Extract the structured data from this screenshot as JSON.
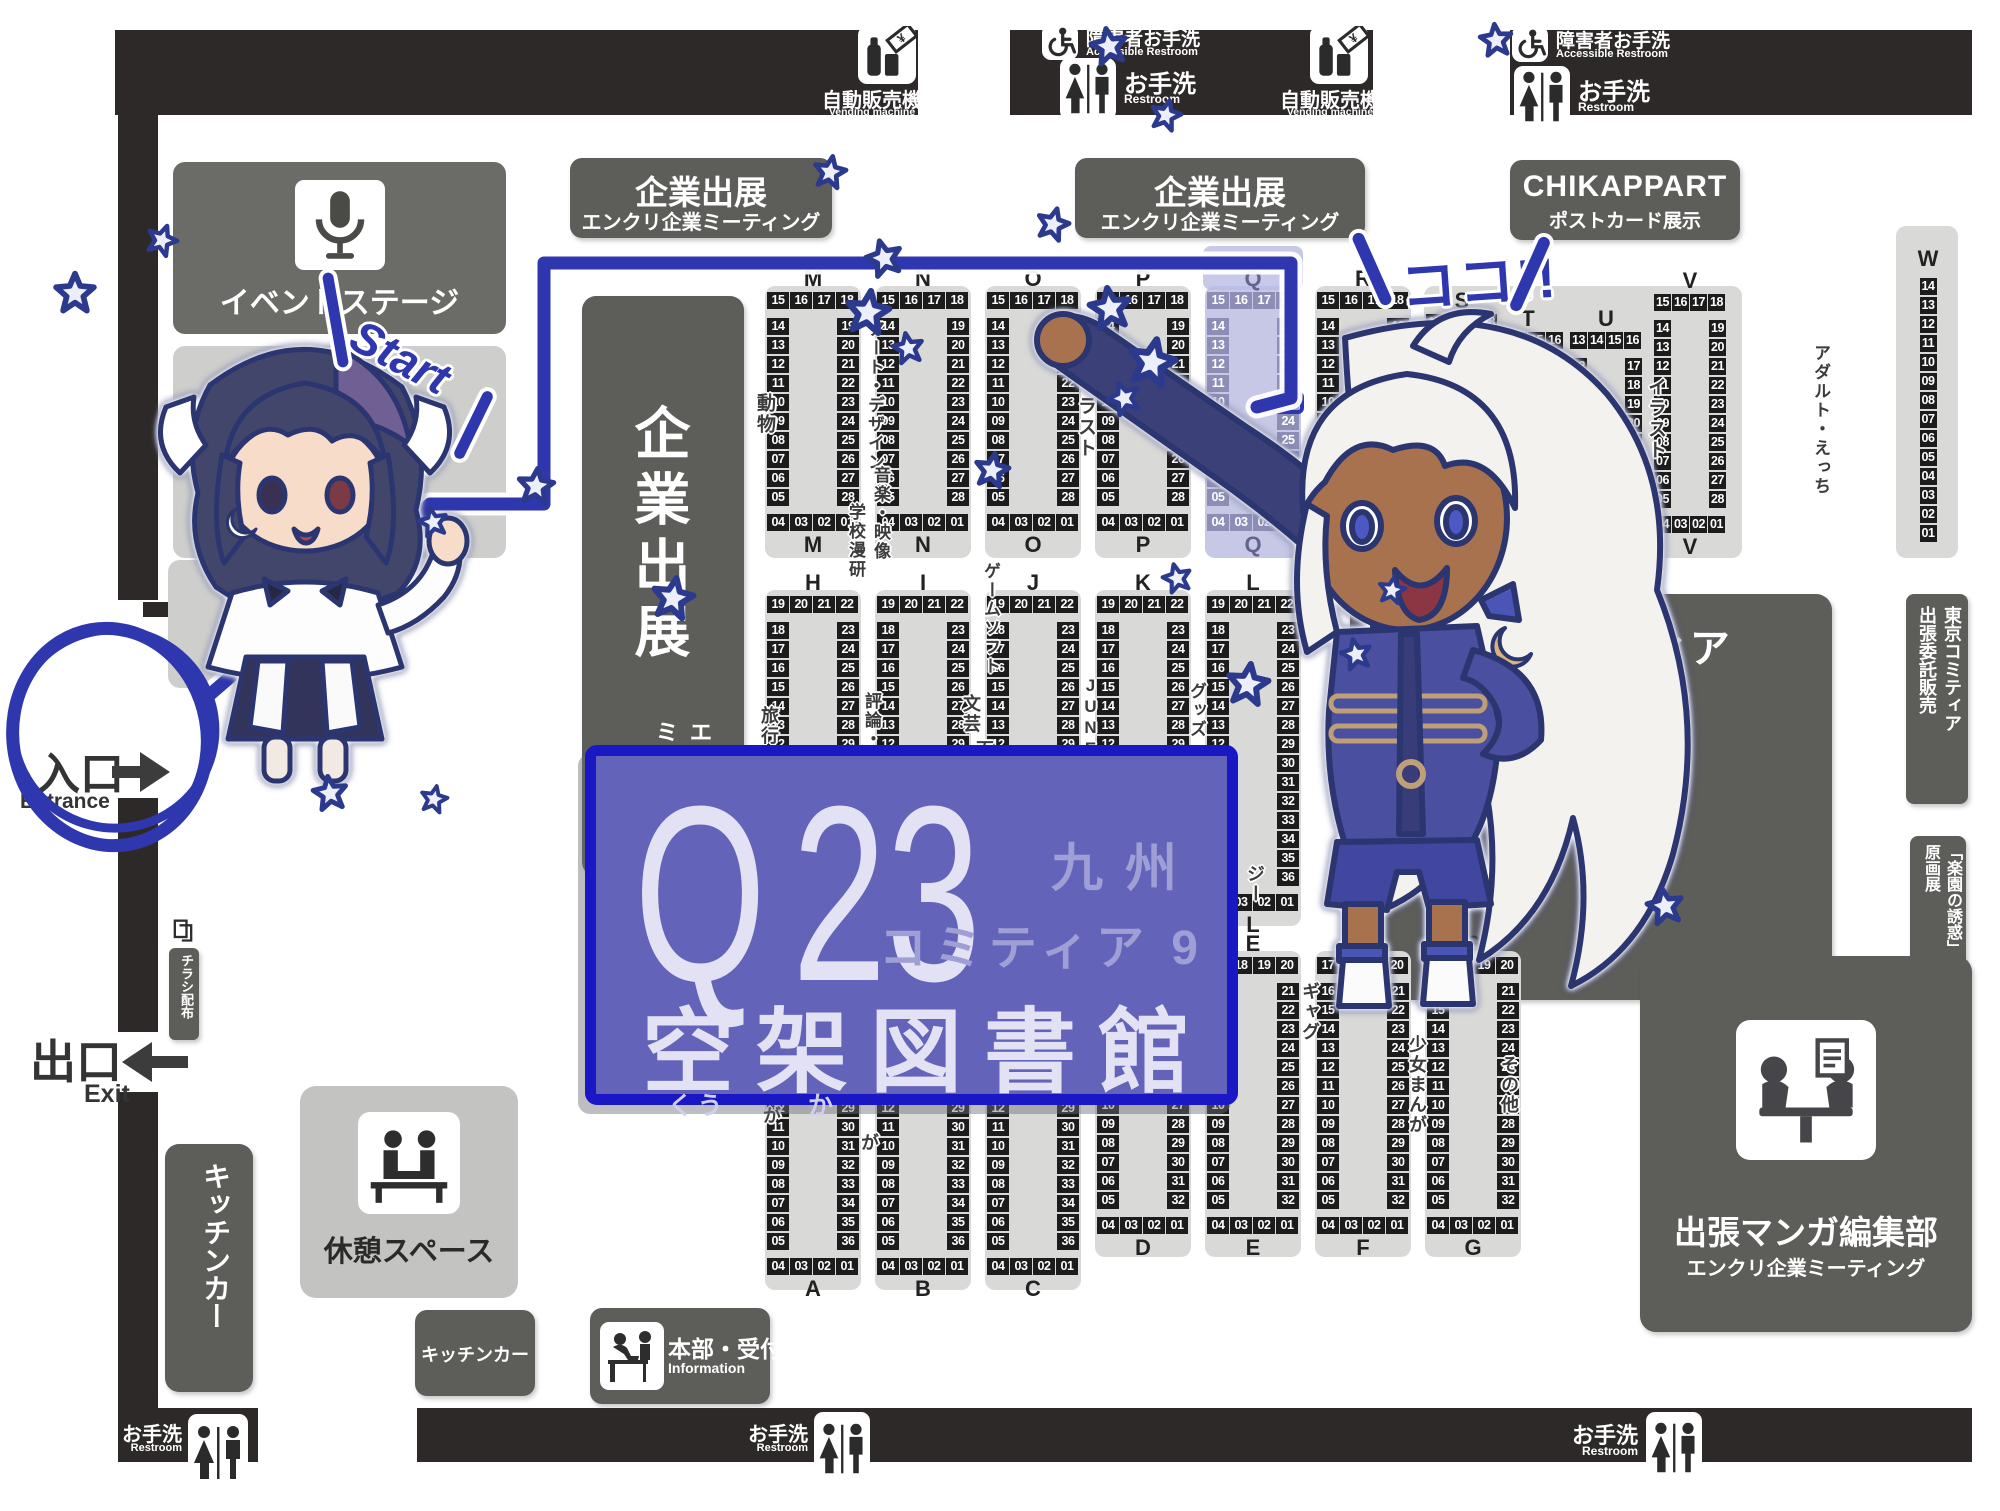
{
  "top_bar": {
    "vending_machine": {
      "jp": "自動販売機",
      "en": "Vending machine"
    },
    "accessible_restroom": {
      "jp": "障害者お手洗",
      "en": "Accessible Restroom"
    },
    "restroom": {
      "jp": "お手洗",
      "en": "Restroom"
    }
  },
  "doors": {
    "entrance_jp": "入口",
    "entrance_en": "Entrance",
    "exit_jp": "出口",
    "exit_en": "Exit"
  },
  "signs": {
    "event_stage": "イベントステージ",
    "corporate_title": "企業出展",
    "corporate_subtitle": "エンクリ企業ミーティング",
    "chikappart_title": "CHIKAPPART",
    "chikappart_subtitle": "ポストカード展示",
    "sample_book_line1": "九州コミティア",
    "sample_book_line2": "見本誌展示",
    "tokyo_line1": "東京コミティア",
    "tokyo_line2": "出張委託販売",
    "rakuen_line1": "「楽園の誘惑」",
    "rakuen_line2": "原画展",
    "editorial_title": "出張マンガ編集部",
    "editorial_subtitle": "エンクリ企業ミーティング",
    "rest_space": "休憩スペース",
    "kitchen_car": "キッチンカー",
    "flyer": "チラシ配布",
    "info_jp": "本部・受付",
    "info_en": "Information"
  },
  "banner": {
    "block": "Q",
    "number": "23",
    "event_line1": "九州",
    "event_line2": "コミティア 9",
    "name": "空架図書館",
    "furigana_sora": "くう",
    "furigana_ka": "か",
    "target": "Q23"
  },
  "annotations": {
    "start": "Start",
    "here": "ココ!!"
  },
  "booth_patterns": {
    "up10": {
      "top": [
        "15",
        "16",
        "17",
        "18"
      ],
      "left": [
        "14",
        "13",
        "12",
        "11",
        "10",
        "09",
        "08",
        "07",
        "06",
        "05"
      ],
      "right": [
        "19",
        "20",
        "21",
        "22",
        "23",
        "24",
        "25",
        "26",
        "27",
        "28"
      ],
      "bottom": [
        "04",
        "03",
        "02",
        "01"
      ]
    },
    "up8": {
      "top": [
        "13",
        "14",
        "15",
        "16"
      ],
      "left": [
        "12",
        "11",
        "10",
        "09",
        "08",
        "07",
        "06",
        "05"
      ],
      "right": [
        "17",
        "18",
        "19",
        "20",
        "21",
        "22",
        "23",
        "24"
      ],
      "bottom": [
        "04",
        "03",
        "02",
        "01"
      ]
    },
    "tall14": {
      "top": [
        "19",
        "20",
        "21",
        "22"
      ],
      "left": [
        "18",
        "17",
        "16",
        "15",
        "14",
        "13",
        "12",
        "11",
        "10",
        "09",
        "08",
        "07",
        "06",
        "05"
      ],
      "right": [
        "23",
        "24",
        "25",
        "26",
        "27",
        "28",
        "29",
        "30",
        "31",
        "32",
        "33",
        "34",
        "35",
        "36"
      ],
      "bottom": [
        "04",
        "03",
        "02",
        "01"
      ]
    },
    "mid12": {
      "top": [
        "17",
        "18",
        "19",
        "20"
      ],
      "left": [
        "16",
        "15",
        "14",
        "13",
        "12",
        "11",
        "10",
        "09",
        "08",
        "07",
        "06",
        "05"
      ],
      "right": [
        "21",
        "22",
        "23",
        "24",
        "25",
        "26",
        "27",
        "28",
        "29",
        "30",
        "31",
        "32"
      ],
      "bottom": [
        "04",
        "03",
        "02",
        "01"
      ]
    },
    "wcol": {
      "col": [
        "14",
        "13",
        "12",
        "11",
        "10",
        "09",
        "08",
        "07",
        "06",
        "05",
        "04",
        "03",
        "02",
        "01"
      ]
    }
  },
  "map": {
    "booth_blocks": [
      {
        "l": "M",
        "p": "up10",
        "cx": 813,
        "y": 268
      },
      {
        "l": "N",
        "p": "up10",
        "cx": 923,
        "y": 268
      },
      {
        "l": "O",
        "p": "up10",
        "cx": 1033,
        "y": 268
      },
      {
        "l": "P",
        "p": "up10",
        "cx": 1143,
        "y": 268
      },
      {
        "l": "Q",
        "p": "up10",
        "cx": 1253,
        "y": 268,
        "hl": true
      },
      {
        "l": "R",
        "p": "up10",
        "cx": 1363,
        "y": 268
      },
      {
        "l": "S",
        "p": "up10",
        "cx": 1462,
        "y": 290,
        "n": true
      },
      {
        "l": "T",
        "p": "up8",
        "cx": 1528,
        "y": 308,
        "n": true
      },
      {
        "l": "U",
        "p": "up8",
        "cx": 1606,
        "y": 308,
        "n": true
      },
      {
        "l": "V",
        "p": "up10",
        "cx": 1690,
        "y": 270,
        "n": true
      },
      {
        "l": "W",
        "p": "wcol",
        "cx": 1928,
        "y": 248,
        "n": true
      },
      {
        "l": "H",
        "p": "tall14",
        "cx": 813,
        "y": 572
      },
      {
        "l": "I",
        "p": "tall14",
        "cx": 923,
        "y": 572
      },
      {
        "l": "J",
        "p": "tall14",
        "cx": 1033,
        "y": 572
      },
      {
        "l": "K",
        "p": "tall14",
        "cx": 1143,
        "y": 572
      },
      {
        "l": "L",
        "p": "tall14",
        "cx": 1253,
        "y": 572
      },
      {
        "l": "A",
        "p": "tall14",
        "cx": 813,
        "y": 936
      },
      {
        "l": "B",
        "p": "tall14",
        "cx": 923,
        "y": 936
      },
      {
        "l": "C",
        "p": "tall14",
        "cx": 1033,
        "y": 936
      },
      {
        "l": "D",
        "p": "mid12",
        "cx": 1143,
        "y": 933
      },
      {
        "l": "E",
        "p": "mid12",
        "cx": 1253,
        "y": 933
      },
      {
        "l": "F",
        "p": "mid12",
        "cx": 1363,
        "y": 933
      },
      {
        "l": "G",
        "p": "mid12",
        "cx": 1473,
        "y": 933
      }
    ],
    "category_labels": [
      {
        "t": "動物",
        "x": 755,
        "y": 393
      },
      {
        "t": "アート・デザイン",
        "x": 866,
        "y": 320,
        "s": 17
      },
      {
        "t": "音楽・映像",
        "x": 872,
        "y": 466,
        "s": 17
      },
      {
        "t": "学校漫研",
        "x": 847,
        "y": 503,
        "s": 17
      },
      {
        "t": "イラスト",
        "x": 1076,
        "y": 375
      },
      {
        "t": "旅行記",
        "x": 760,
        "y": 706,
        "s": 18
      },
      {
        "t": "評論・情報",
        "x": 863,
        "y": 692,
        "s": 17
      },
      {
        "t": "文芸",
        "x": 962,
        "y": 694,
        "s": 18
      },
      {
        "t": "百合",
        "x": 975,
        "y": 740,
        "s": 18
      },
      {
        "t": "ゲームソフト",
        "x": 982,
        "y": 562,
        "s": 17
      },
      {
        "t": "JUNE",
        "x": 1082,
        "y": 676,
        "s": 17
      },
      {
        "t": "グッズ・",
        "x": 1188,
        "y": 682,
        "s": 17
      },
      {
        "t": "ジー",
        "x": 1246,
        "y": 864,
        "s": 18
      },
      {
        "t": "まんが",
        "x": 762,
        "y": 1066,
        "s": 18
      },
      {
        "t": "が",
        "x": 860,
        "y": 1133,
        "s": 18
      },
      {
        "t": "ギャグ",
        "x": 1301,
        "y": 982,
        "s": 18
      },
      {
        "t": "少女まんが",
        "x": 1408,
        "y": 1035,
        "s": 18
      },
      {
        "t": "その他",
        "x": 1500,
        "y": 1055,
        "s": 18
      },
      {
        "t": "イラスト",
        "x": 1646,
        "y": 377
      },
      {
        "t": "アダルト・えっち",
        "x": 1812,
        "y": 344,
        "s": 17
      }
    ],
    "extra_platforms": [
      [
        1424,
        286,
        318,
        272
      ],
      [
        1896,
        226,
        62,
        332
      ]
    ]
  },
  "route": {
    "points": [
      [
        206,
        698
      ],
      [
        430,
        504
      ],
      [
        544,
        504
      ],
      [
        544,
        263
      ],
      [
        1291,
        263
      ],
      [
        1291,
        398
      ],
      [
        1257,
        407
      ]
    ],
    "color": "#2e37ae"
  },
  "decorations": {
    "stars": [
      [
        75,
        293,
        44,
        0
      ],
      [
        162,
        240,
        34,
        20
      ],
      [
        830,
        172,
        36,
        10
      ],
      [
        884,
        258,
        40,
        -15
      ],
      [
        868,
        312,
        48,
        8
      ],
      [
        908,
        348,
        34,
        -10
      ],
      [
        1053,
        224,
        36,
        15
      ],
      [
        1110,
        308,
        46,
        -8
      ],
      [
        1152,
        362,
        52,
        12
      ],
      [
        1124,
        398,
        36,
        -20
      ],
      [
        536,
        486,
        40,
        6
      ],
      [
        433,
        522,
        32,
        -12
      ],
      [
        673,
        598,
        46,
        10
      ],
      [
        1109,
        46,
        40,
        -10
      ],
      [
        1166,
        115,
        34,
        14
      ],
      [
        1496,
        40,
        36,
        -6
      ],
      [
        992,
        470,
        38,
        10
      ],
      [
        1177,
        578,
        32,
        -14
      ],
      [
        1248,
        684,
        46,
        8
      ],
      [
        1356,
        654,
        34,
        -12
      ],
      [
        1392,
        590,
        30,
        10
      ],
      [
        330,
        793,
        38,
        -8
      ],
      [
        434,
        799,
        30,
        12
      ],
      [
        1665,
        906,
        40,
        -10
      ]
    ]
  },
  "colors": {
    "wall": "#2e2929",
    "box_dark": "#5d5d5a",
    "platform": "#d9d9d7",
    "cell": "#1c1c1c",
    "banner_bg": "#6463ba",
    "banner_border": "#1a17c5",
    "accent_blue": "#2e37ae",
    "highlight_platform": "#c7c8e5",
    "highlight_cell": "#8d8eb6"
  }
}
